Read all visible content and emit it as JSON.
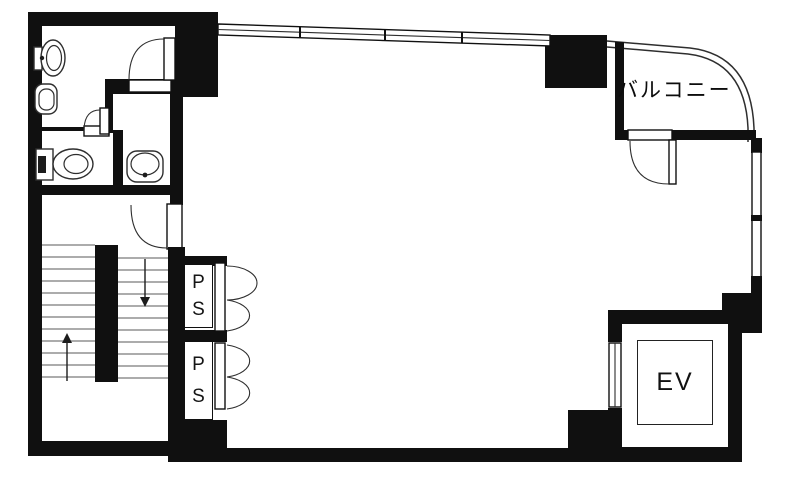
{
  "labels": {
    "balcony": "バルコニー",
    "elevator": "EV",
    "pipe_space_upper": {
      "line1": "P",
      "line2": "S"
    },
    "pipe_space_lower": {
      "line1": "P",
      "line2": "S"
    }
  },
  "fixtures": {
    "upper_left_room": [
      "toilet",
      "utility-sink"
    ],
    "wc_room": [
      "tank-toilet"
    ],
    "basin_room": [
      "wash-basin"
    ],
    "stairs": {
      "left_flight_arrow": "up",
      "right_flight_arrow": "down"
    }
  },
  "colors": {
    "wall": "#101010",
    "line": "#2e2e2e",
    "tread": "#5a5a5a",
    "background": "#ffffff"
  }
}
